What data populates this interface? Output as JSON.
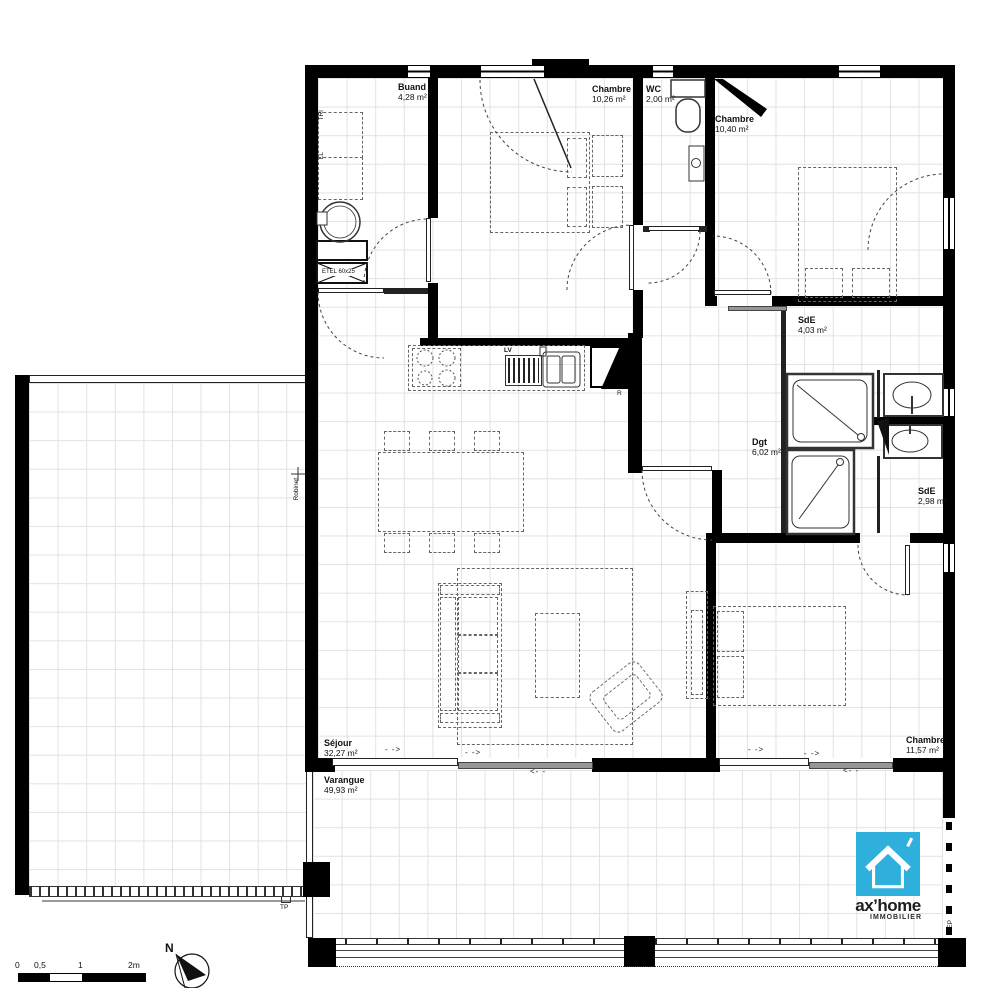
{
  "plan": {
    "rooms": [
      {
        "name": "Buand",
        "area": "4,28 m²"
      },
      {
        "name": "Chambre",
        "area": "10,26 m²"
      },
      {
        "name": "WC",
        "area": "2,00 m²"
      },
      {
        "name": "Chambre",
        "area": "10,40 m²"
      },
      {
        "name": "SdE",
        "area": "4,03 m²"
      },
      {
        "name": "Dgt",
        "area": "6,02 m²"
      },
      {
        "name": "SdE",
        "area": "2,98 m²"
      },
      {
        "name": "Séjour",
        "area": "32,27 m²"
      },
      {
        "name": "Varangue",
        "area": "49,93 m²"
      },
      {
        "name": "Chambre",
        "area": "11,57 m²"
      }
    ],
    "fixtures": {
      "tri": "TRI",
      "ll": "LL",
      "etel": "ETEL 60x25",
      "lv": "LV",
      "fridge": "R",
      "robinet": "Robinet",
      "tp": "TP",
      "ep": "EP"
    },
    "arrows": {
      "right": "- ->",
      "left": "<- -"
    }
  },
  "scalebar": {
    "t0": "0",
    "t05": "0,5",
    "t1": "1",
    "t2": "2m"
  },
  "compass": {
    "label": "N"
  },
  "logo": {
    "brand": "ax’home",
    "sub": "IMMOBILIER",
    "color": "#2fb0dc"
  }
}
